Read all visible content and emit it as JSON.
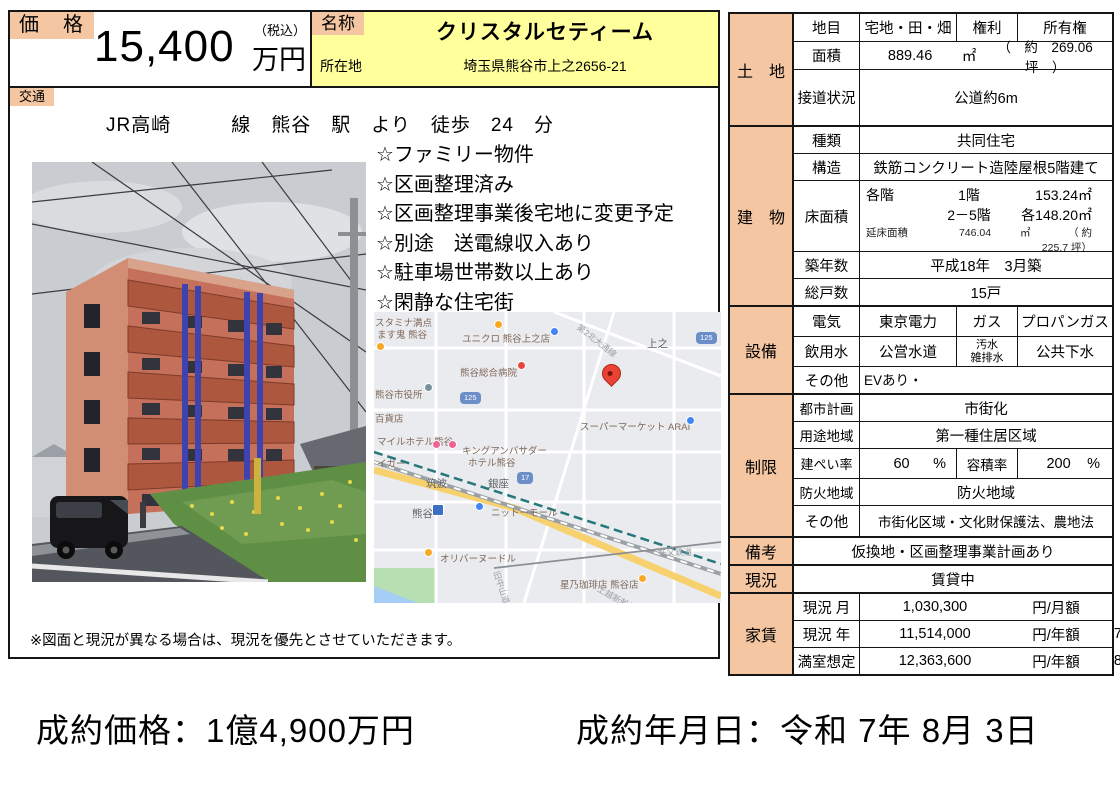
{
  "colors": {
    "salmon": "#f4c6a1",
    "yellow": "#ffff9c",
    "pin_red": "#ea4335"
  },
  "price_box": {
    "label": "価　格",
    "value": "15,400",
    "tax_note": "（税込）",
    "unit": "万円"
  },
  "name_box": {
    "label": "名称",
    "name": "クリスタルセティーム",
    "address_label": "所在地",
    "address": "埼玉県熊谷市上之2656-21"
  },
  "transit": {
    "label": "交通",
    "text": "JR高崎　　　線　熊谷　駅　より　徒歩　24　分"
  },
  "features": [
    "☆ファミリー物件",
    "☆区画整理済み",
    "☆区画整理事業後宅地に変更予定",
    "☆別途　送電線収入あり",
    "☆駐車場世帯数以上あり",
    "☆閑静な住宅街"
  ],
  "note": "※図面と現況が異なる場合は、現況を優先とさせていただきます。",
  "table": {
    "tochi": {
      "section": "土　地",
      "chimoku_label": "地目",
      "chimoku": "宅地・田・畑",
      "kenri_label": "権利",
      "kenri": "所有権",
      "menseki_label": "面積",
      "menseki": "889.46",
      "menseki_unit": "㎡",
      "menseki_tsubo": "（　約　269.06　坪　）",
      "setsudo_label": "接道状況",
      "setsudo": "公道約6m"
    },
    "tatemono": {
      "section": "建　物",
      "shurui_label": "種類",
      "shurui": "共同住宅",
      "kozo_label": "構造",
      "kozo": "鉄筋コンクリート造陸屋根5階建て",
      "yuka_label": "床面積",
      "kakukai": "各階",
      "f1_label": "1階",
      "f1": "153.24㎡",
      "f25_label": "2－5階",
      "f25": "各148.20㎡",
      "nobeyuka_label": "延床面積",
      "nobeyuka": "746.04",
      "nobeyuka_unit": "㎡",
      "nobeyuka_tsubo": "（ 約　 225.7 坪）",
      "chiku_label": "築年数",
      "chiku": "平成18年　3月築",
      "soko_label": "総戸数",
      "soko": "15戸"
    },
    "setsubi": {
      "section": "設備",
      "denki_label": "電気",
      "denki": "東京電力",
      "gas_label": "ガス",
      "gas": "プロパンガス",
      "insui_label": "飲用水",
      "insui": "公営水道",
      "osui_label": "汚水\n雑排水",
      "osui": "公共下水",
      "sonota_label": "その他",
      "sonota": "EVあり・"
    },
    "seigen": {
      "section": "制限",
      "toshi_label": "都市計画",
      "toshi": "市街化",
      "yoto_label": "用途地域",
      "yoto": "第一種住居区域",
      "kenpei_label": "建ぺい率",
      "kenpei": "60",
      "kenpei_unit": "%",
      "yoseki_label": "容積率",
      "yoseki": "200",
      "yoseki_unit": "%",
      "boka_label": "防火地域",
      "boka": "防火地域",
      "sonota_label": "その他",
      "sonota": "市街化区域・文化財保護法、農地法"
    },
    "biko": {
      "label": "備考",
      "value": "仮換地・区画整理事業計画あり"
    },
    "genkyo": {
      "label": "現況",
      "value": "賃貸中"
    },
    "yachin": {
      "section": "家賃",
      "tsuki_label": "現況 月",
      "tsuki": "1,030,300",
      "tsuki_unit": "円/月額",
      "nen_label": "現況 年",
      "nen": "11,514,000",
      "nen_unit": "円/年額",
      "nen_rate": "7.22",
      "nen_rate_unit": "%",
      "man_label": "満室想定",
      "man": "12,363,600",
      "man_unit": "円/年額",
      "man_rate": "8.02",
      "man_rate_unit": "%"
    }
  },
  "map": {
    "pin_label": "クリスタルセティーム",
    "labels": [
      {
        "text": "スタミナ満点",
        "x": 1,
        "y": 7,
        "cls": "poi"
      },
      {
        "text": "ます鬼 熊谷",
        "x": 3,
        "y": 19,
        "cls": "poi"
      },
      {
        "text": "ユニクロ 熊谷上之店",
        "x": 88,
        "y": 23,
        "cls": "poi"
      },
      {
        "text": "上之",
        "x": 273,
        "y": 27,
        "cls": "loc"
      },
      {
        "text": "第2北大通線",
        "x": 204,
        "y": 10,
        "cls": "road",
        "rot": 38
      },
      {
        "text": "熊谷総合病院",
        "x": 86,
        "y": 57,
        "cls": "poi"
      },
      {
        "text": "熊谷市役所",
        "x": 1,
        "y": 79,
        "cls": "poi"
      },
      {
        "text": "百貨店",
        "x": 1,
        "y": 103,
        "cls": "poi"
      },
      {
        "text": "スーパーマーケット ARAI",
        "x": 206,
        "y": 111,
        "cls": "poi"
      },
      {
        "text": "マイルホテル熊谷",
        "x": 3,
        "y": 126,
        "cls": "poi"
      },
      {
        "text": "イガー",
        "x": 3,
        "y": 148,
        "cls": "poi"
      },
      {
        "text": "キングアンバサダー",
        "x": 88,
        "y": 135,
        "cls": "poi"
      },
      {
        "text": "ホテル熊谷",
        "x": 94,
        "y": 147,
        "cls": "poi"
      },
      {
        "text": "筑波",
        "x": 52,
        "y": 167,
        "cls": "loc"
      },
      {
        "text": "銀座",
        "x": 114,
        "y": 167,
        "cls": "loc"
      },
      {
        "text": "熊谷",
        "x": 38,
        "y": 197,
        "cls": "loc"
      },
      {
        "text": "ニットーモール",
        "x": 117,
        "y": 197,
        "cls": "poi"
      },
      {
        "text": "オリバーヌードル",
        "x": 66,
        "y": 243,
        "cls": "poi"
      },
      {
        "text": "星乃珈琲店 熊谷店",
        "x": 186,
        "y": 269,
        "cls": "poi"
      },
      {
        "text": "秩父鉄道",
        "x": 284,
        "y": 236,
        "cls": "road"
      },
      {
        "text": "旧中山道",
        "x": 122,
        "y": 255,
        "cls": "road",
        "rot": 72
      },
      {
        "text": "上越新幹線",
        "x": 224,
        "y": 272,
        "cls": "road",
        "rot": 30
      }
    ],
    "badges": [
      {
        "text": "125",
        "x": 322,
        "y": 20
      },
      {
        "text": "125",
        "x": 86,
        "y": 80
      },
      {
        "text": "17",
        "x": 143,
        "y": 160
      }
    ],
    "pins": [
      {
        "x": 176,
        "y": 15,
        "color": "#4285f4"
      },
      {
        "x": 143,
        "y": 49,
        "color": "#e8453c"
      },
      {
        "x": 50,
        "y": 71,
        "color": "#78909c"
      },
      {
        "x": 312,
        "y": 104,
        "color": "#4285f4"
      },
      {
        "x": 58,
        "y": 128,
        "color": "#f06292"
      },
      {
        "x": 74,
        "y": 128,
        "color": "#f06292"
      },
      {
        "x": 101,
        "y": 190,
        "color": "#4285f4"
      },
      {
        "x": 50,
        "y": 236,
        "color": "#f9a825"
      },
      {
        "x": 264,
        "y": 262,
        "color": "#f9a825"
      },
      {
        "x": 120,
        "y": 8,
        "color": "#f9a825"
      },
      {
        "x": 2,
        "y": 30,
        "color": "#f9a825"
      }
    ],
    "station": {
      "x": 58,
      "y": 192
    }
  },
  "footer": {
    "price": "成約価格：1億4,900万円",
    "date": "成約年月日：令和 7年 8月 3日"
  }
}
